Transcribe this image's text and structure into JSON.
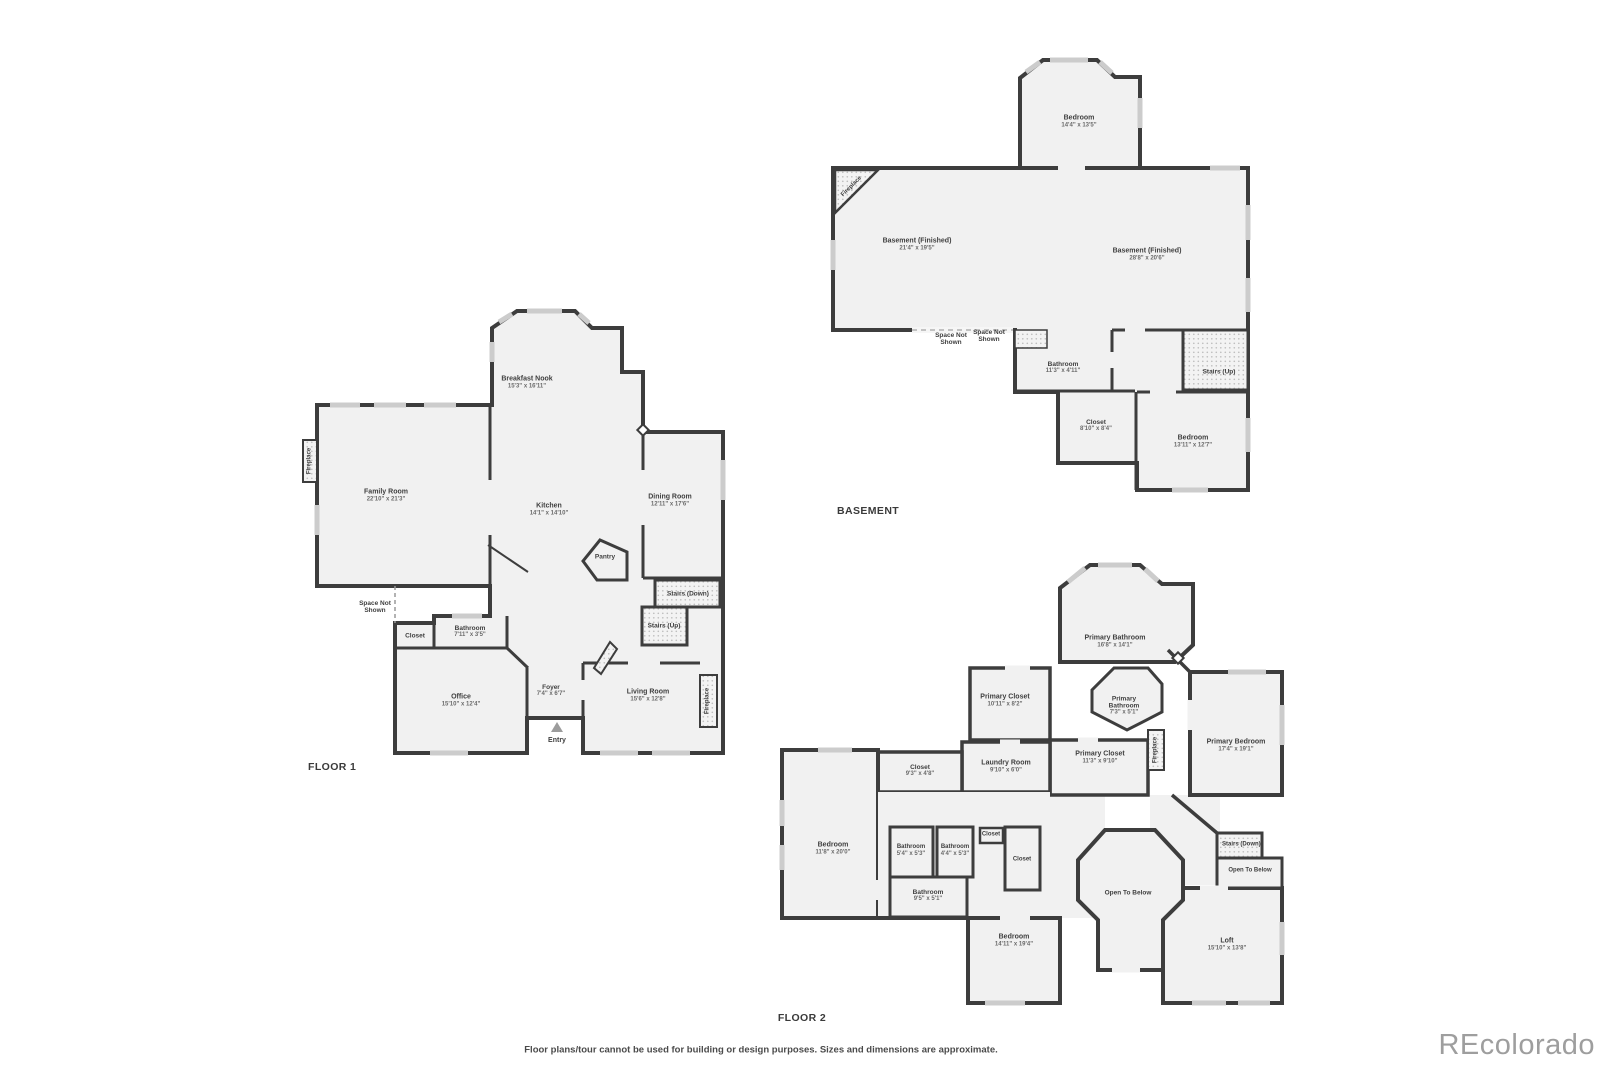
{
  "page": {
    "disclaimer": "Floor plans/tour cannot be used for building or design purposes. Sizes and dimensions are approximate.",
    "watermark": "REcolorado",
    "colors": {
      "wall": "#3d3d3d",
      "room_fill": "#f1f1f1",
      "window": "#cccccc",
      "watermark_gray": "#9e9e9e"
    }
  },
  "floor1": {
    "title": "FLOOR 1",
    "rooms": {
      "breakfast_nook": {
        "name": "Breakfast Nook",
        "dims": "15'3\" x 16'11\""
      },
      "family_room": {
        "name": "Family Room",
        "dims": "22'10\" x 21'3\""
      },
      "kitchen": {
        "name": "Kitchen",
        "dims": "14'1\" x 14'10\""
      },
      "dining_room": {
        "name": "Dining Room",
        "dims": "12'11\" x 17'6\""
      },
      "bathroom": {
        "name": "Bathroom",
        "dims": "7'11\" x 3'5\""
      },
      "office": {
        "name": "Office",
        "dims": "15'10\" x 12'4\""
      },
      "foyer": {
        "name": "Foyer",
        "dims": "7'4\" x 6'7\""
      },
      "living_room": {
        "name": "Living Room",
        "dims": "15'6\" x 12'8\""
      }
    },
    "labels": {
      "pantry": "Pantry",
      "closet": "Closet",
      "entry": "Entry",
      "stairs_down": "Stairs (Down)",
      "stairs_up": "Stairs (Up)",
      "space_not_shown": "Space Not Shown",
      "fireplace": "Fireplace"
    }
  },
  "basement": {
    "title": "BASEMENT",
    "rooms": {
      "bedroom_top": {
        "name": "Bedroom",
        "dims": "14'4\" x 13'5\""
      },
      "finished_left": {
        "name": "Basement (Finished)",
        "dims": "21'4\" x 19'5\""
      },
      "finished_right": {
        "name": "Basement (Finished)",
        "dims": "28'8\" x 20'6\""
      },
      "bathroom": {
        "name": "Bathroom",
        "dims": "11'3\" x 4'11\""
      },
      "closet": {
        "name": "Closet",
        "dims": "8'10\" x 8'4\""
      },
      "bedroom_bottom": {
        "name": "Bedroom",
        "dims": "13'11\" x 12'7\""
      }
    },
    "labels": {
      "stairs_up": "Stairs (Up)",
      "space_not_shown": "Space Not Shown",
      "fireplace": "Fireplace"
    }
  },
  "floor2": {
    "title": "FLOOR 2",
    "rooms": {
      "primary_bathroom": {
        "name": "Primary Bathroom",
        "dims": "16'8\" x 14'1\""
      },
      "primary_closet_left": {
        "name": "Primary Closet",
        "dims": "10'11\" x 8'2\""
      },
      "primary_bathroom_small": {
        "name": "Primary Bathroom",
        "dims": "7'3\" x 5'1\""
      },
      "primary_closet_center": {
        "name": "Primary Closet",
        "dims": "11'3\" x 9'10\""
      },
      "laundry_room": {
        "name": "Laundry Room",
        "dims": "9'10\" x 6'0\""
      },
      "closet_93": {
        "name": "Closet",
        "dims": "9'3\" x 4'8\""
      },
      "primary_bedroom": {
        "name": "Primary Bedroom",
        "dims": "17'4\" x 19'1\""
      },
      "bedroom_left": {
        "name": "Bedroom",
        "dims": "11'8\" x 20'0\""
      },
      "bathroom_a": {
        "name": "Bathroom",
        "dims": "5'4\" x 5'3\""
      },
      "bathroom_b": {
        "name": "Bathroom",
        "dims": "4'4\" x 5'3\""
      },
      "bathroom_c": {
        "name": "Bathroom",
        "dims": "9'5\" x 5'1\""
      },
      "bedroom_bottom": {
        "name": "Bedroom",
        "dims": "14'11\" x 19'4\""
      },
      "loft": {
        "name": "Loft",
        "dims": "15'10\" x 13'8\""
      }
    },
    "labels": {
      "closet": "Closet",
      "stairs_down": "Stairs (Down)",
      "open_to_below": "Open To Below",
      "fireplace": "Fireplace"
    }
  }
}
